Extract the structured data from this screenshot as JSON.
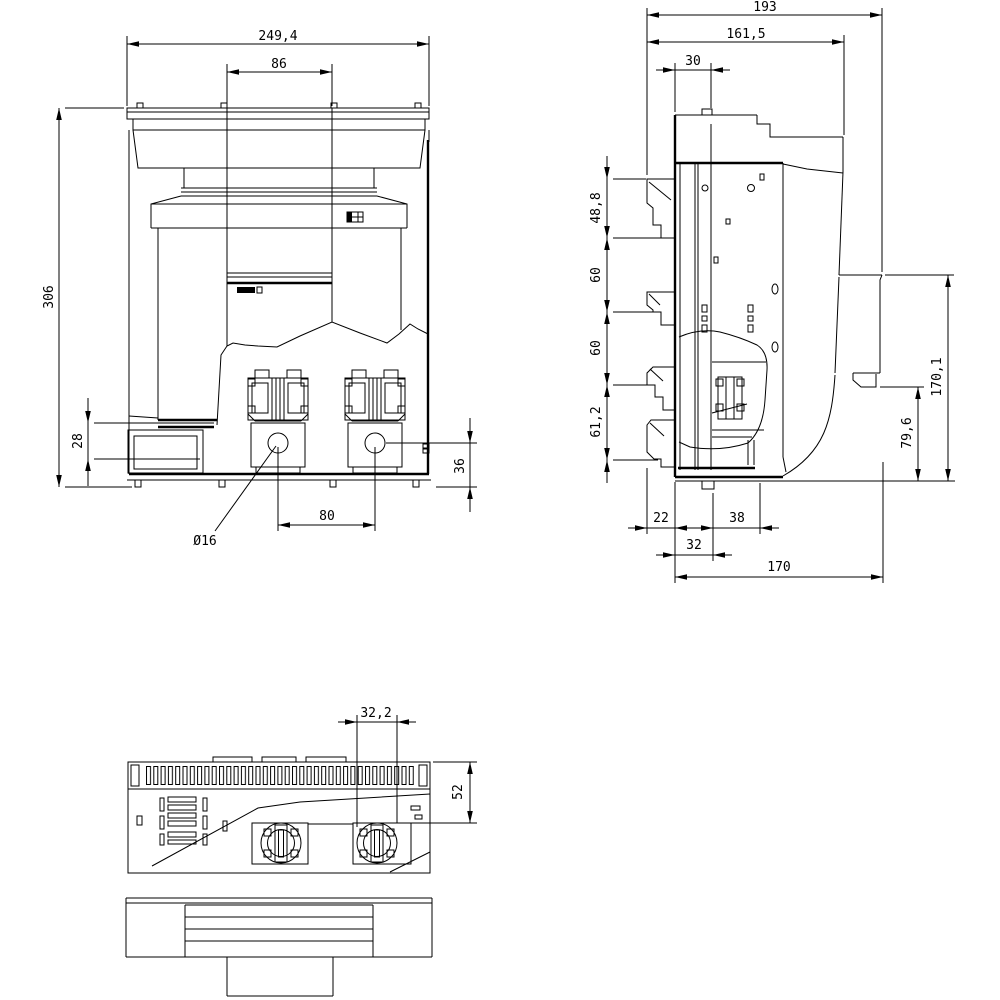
{
  "colors": {
    "line": "#000000",
    "background": "#ffffff"
  },
  "views": {
    "front": {
      "dims": {
        "w_total": "249,4",
        "w_center": "86",
        "h_total": "306",
        "h_block": "28",
        "h_hole": "36",
        "hole_pitch": "80",
        "hole_dia": "Ø16"
      }
    },
    "side": {
      "dims": {
        "d_total": "193",
        "d_body": "161,5",
        "d_top": "30",
        "v_top": "48,8",
        "v_mid1": "60",
        "v_mid2": "60",
        "v_bottom": "61,2",
        "h_total": "170,1",
        "h_lower": "79,6",
        "b_front": "22",
        "b_mid": "38",
        "b_offset": "32",
        "b_total": "170"
      }
    },
    "bottom": {
      "dims": {
        "w_slot": "32,2",
        "h_edge": "52"
      }
    }
  }
}
